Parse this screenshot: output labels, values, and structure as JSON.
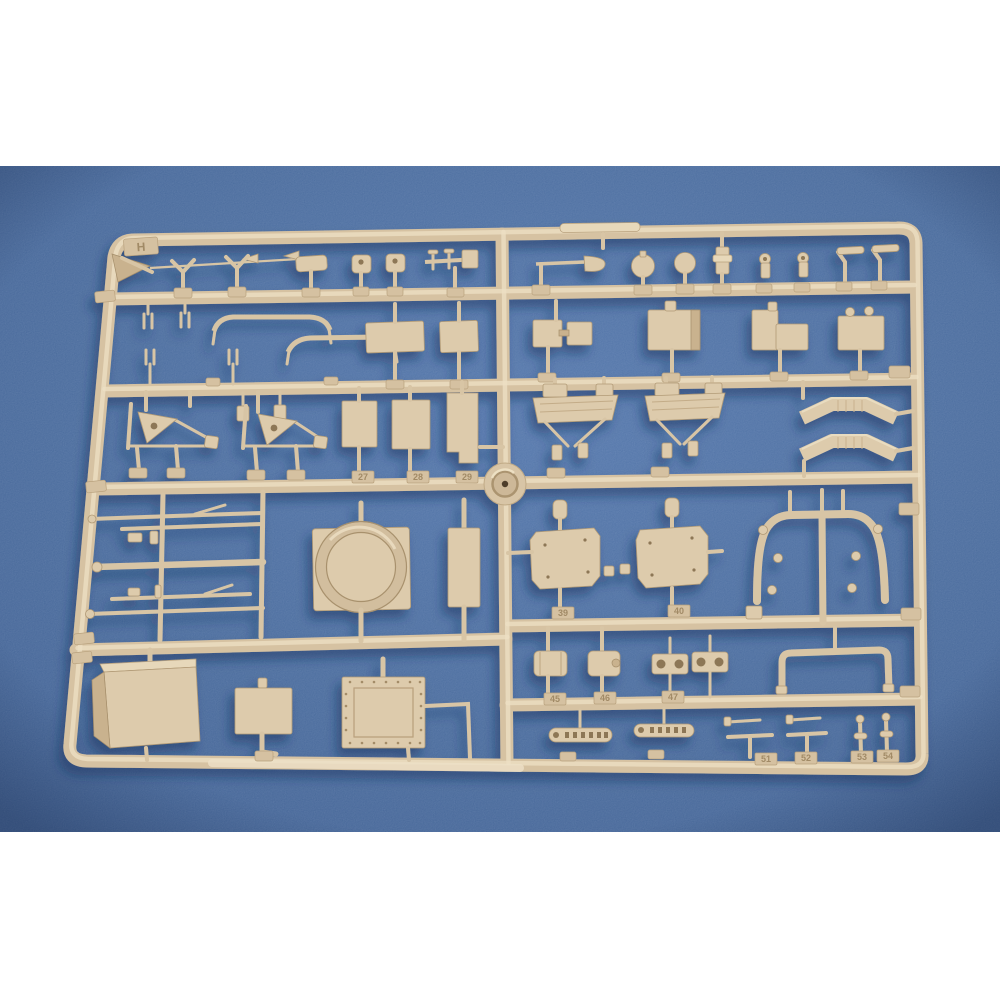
{
  "photo": {
    "subject": "plastic model kit parts sprue on blue fabric backdrop",
    "sprue_letter": "H",
    "part_tags": [
      {
        "label": "27"
      },
      {
        "label": "28"
      },
      {
        "label": "29"
      },
      {
        "label": "39"
      },
      {
        "label": "40"
      },
      {
        "label": "45"
      },
      {
        "label": "46"
      },
      {
        "label": "47"
      },
      {
        "label": "51"
      },
      {
        "label": "52"
      },
      {
        "label": "53"
      },
      {
        "label": "54"
      }
    ],
    "colors": {
      "band_white": "#ffffff",
      "backdrop_blue": "#44689e",
      "sprue_tan": "#dccaab",
      "sprue_highlight": "#ecdfc3",
      "sprue_shadow_edge": "#b19a76",
      "cast_shadow_blue": "#17335c"
    }
  }
}
